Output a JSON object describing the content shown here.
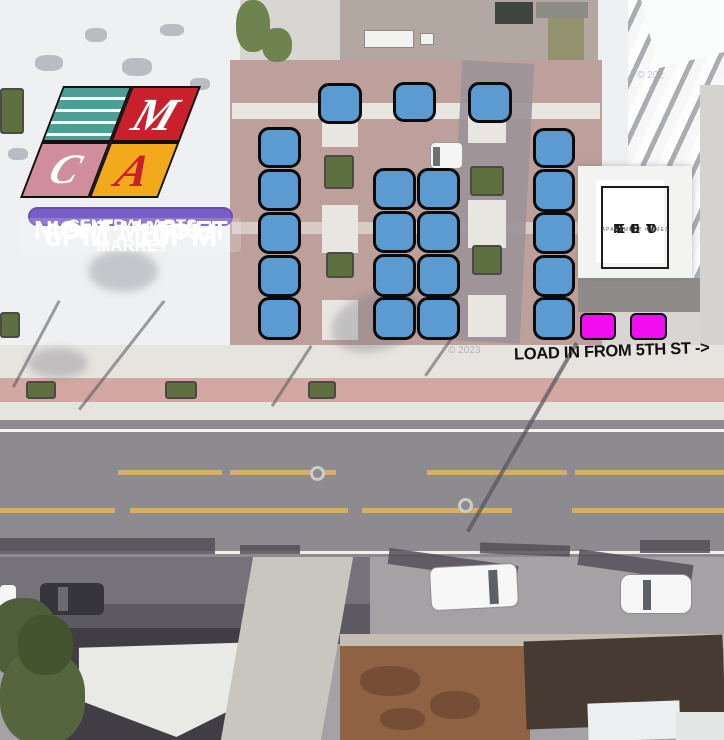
{
  "logo": {
    "m": "M",
    "c": "C",
    "a": "A",
    "colors": {
      "teal": "#4E9E96",
      "red": "#C9202E",
      "pink": "#D08E9C",
      "yellow": "#F2A91C"
    }
  },
  "banner": {
    "line1": "CENTRAL ARTS MARKET",
    "line2": "NIGHT MARKET",
    "line3": "6PM - 10PM",
    "bg_color": "#7A5EC8"
  },
  "roosevelt": {
    "line1": "ROO",
    "line2": "SEV",
    "line3": "ELT",
    "subtext": "APARTMENT HOMES"
  },
  "load_in": {
    "text": "LOAD IN FROM 5TH ST ->"
  },
  "watermarks": {
    "plaza": "© 2023",
    "top_right": "© 202"
  },
  "booths": {
    "blue_color": "#5B9BD2",
    "magenta_color": "#F10DF0",
    "blue": [
      [
        318,
        83,
        44,
        41
      ],
      [
        393,
        82,
        43,
        40
      ],
      [
        468,
        82,
        44,
        41
      ],
      [
        258,
        127,
        43,
        41
      ],
      [
        258,
        169,
        43,
        42
      ],
      [
        258,
        212,
        43,
        42
      ],
      [
        258,
        255,
        43,
        42
      ],
      [
        258,
        297,
        43,
        43
      ],
      [
        373,
        168,
        43,
        42
      ],
      [
        373,
        211,
        43,
        42
      ],
      [
        373,
        254,
        43,
        43
      ],
      [
        373,
        297,
        43,
        43
      ],
      [
        417,
        168,
        43,
        42
      ],
      [
        417,
        211,
        43,
        42
      ],
      [
        417,
        254,
        43,
        43
      ],
      [
        417,
        297,
        43,
        43
      ],
      [
        533,
        128,
        42,
        40
      ],
      [
        533,
        169,
        42,
        43
      ],
      [
        533,
        212,
        42,
        42
      ],
      [
        533,
        255,
        42,
        42
      ],
      [
        533,
        297,
        42,
        43
      ]
    ],
    "magenta": [
      [
        580,
        313,
        36,
        27
      ],
      [
        630,
        313,
        37,
        27
      ]
    ]
  }
}
